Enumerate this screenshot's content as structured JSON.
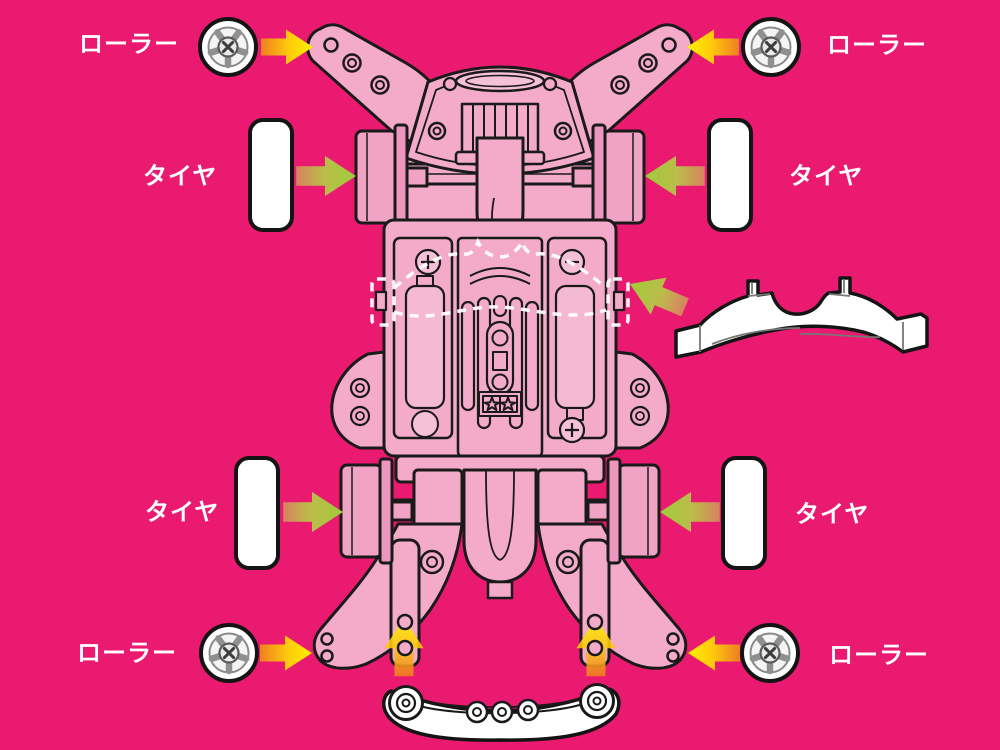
{
  "canvas": {
    "width": 1000,
    "height": 750,
    "background_color": "#E91A70"
  },
  "labels": {
    "roller_front_left": "ローラー",
    "roller_front_right": "ローラー",
    "tire_front_left": "タイヤ",
    "tire_front_right": "タイヤ",
    "tire_rear_left": "タイヤ",
    "tire_rear_right": "タイヤ",
    "roller_rear_left": "ローラー",
    "roller_rear_right": "ローラー"
  },
  "colors": {
    "background": "#E91A70",
    "chassis_pink": "#F3ABC9",
    "chassis_pink_light": "#F6C0D7",
    "wheel_pink": "#F1A3C6",
    "wheel_flange_pink": "#EE97BE",
    "outline": "#1A1A1A",
    "label_text": "#FFFFFF",
    "arrow_yellow": "#FFF200",
    "arrow_orange": "#F7941D",
    "arrow_green": "#A0CB3A",
    "arrow_green_tail": "#D8825F",
    "detached_part_white": "#FFFFFF",
    "dashed_guide": "#FFFFFF"
  },
  "icons": {
    "roller": "roller-wheel-icon",
    "tire": "tire-icon",
    "chassis": "mini4wd-chassis-underside-illustration",
    "gear_cover_part": "gear-cover-part-icon",
    "rear_stay_part": "rear-roller-stay-part-icon",
    "arrow": "assembly-direction-arrow"
  }
}
